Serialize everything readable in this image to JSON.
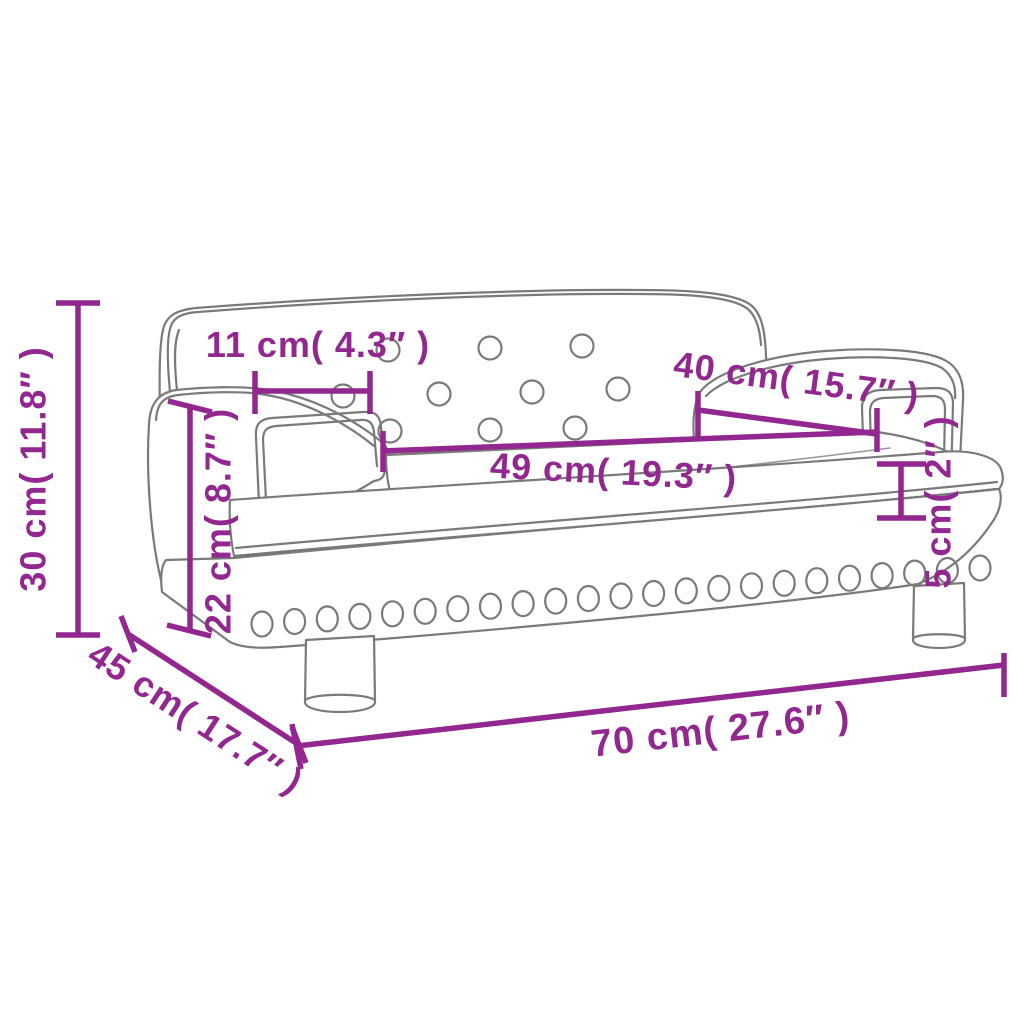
{
  "colors": {
    "accent": "#92278F",
    "outline": "#7a7a7a",
    "background": "#ffffff"
  },
  "dimensions": {
    "height": {
      "label": "30 cm( 11.8″ )"
    },
    "backrest_top_width": {
      "label": "11 cm( 4.3″ )"
    },
    "arm_to_back": {
      "label": "40 cm( 15.7″ )"
    },
    "seat_width": {
      "label": "49 cm( 19.3″ )"
    },
    "arm_height": {
      "label": "22 cm( 8.7″ )"
    },
    "seat_thickness": {
      "label": "5 cm( 2″ )"
    },
    "depth": {
      "label": "45 cm( 17.7″ )"
    },
    "width": {
      "label": "70 cm( 27.6″ )"
    }
  }
}
